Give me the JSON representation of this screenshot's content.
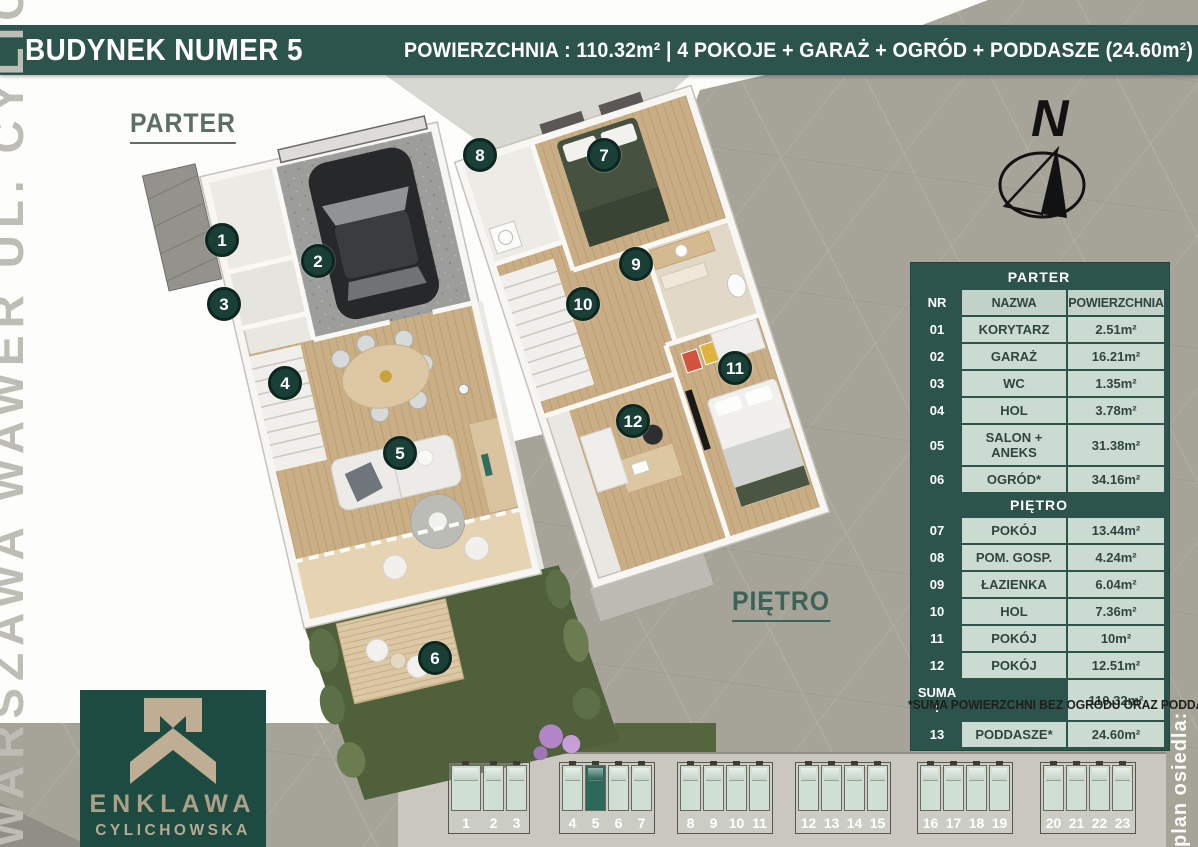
{
  "header": {
    "title": "BUDYNEK NUMER  5",
    "subtitle": "POWIERZCHNIA :  110.32m²  |  4 POKOJE + GARAŻ + OGRÓD + PODDASZE (24.60m²)"
  },
  "side_labels": {
    "left_vertical": "WARSZAWA WAWER UL. CYLICHOWSKA",
    "right_vertical": "plan osiedla:"
  },
  "floors": {
    "ground_label": "PARTER",
    "upper_label": "PIĘTRO"
  },
  "compass": {
    "north": "N"
  },
  "markers": {
    "parter": [
      "1",
      "2",
      "3",
      "4",
      "5",
      "6"
    ],
    "pietro": [
      "7",
      "8",
      "9",
      "10",
      "11",
      "12"
    ]
  },
  "table": {
    "section_parter": "PARTER",
    "columns": [
      "NR",
      "NAZWA",
      "POWIERZCHNIA"
    ],
    "parter_rows": [
      [
        "01",
        "KORYTARZ",
        "2.51m²"
      ],
      [
        "02",
        "GARAŻ",
        "16.21m²"
      ],
      [
        "03",
        "WC",
        "1.35m²"
      ],
      [
        "04",
        "HOL",
        "3.78m²"
      ],
      [
        "05",
        "SALON + ANEKS",
        "31.38m²"
      ],
      [
        "06",
        "OGRÓD*",
        "34.16m²"
      ]
    ],
    "section_pietro": "PIĘTRO",
    "pietro_rows": [
      [
        "07",
        "POKÓJ",
        "13.44m²"
      ],
      [
        "08",
        "POM. GOSP.",
        "4.24m²"
      ],
      [
        "09",
        "ŁAZIENKA",
        "6.04m²"
      ],
      [
        "10",
        "HOL",
        "7.36m²"
      ],
      [
        "11",
        "POKÓJ",
        "10m²"
      ],
      [
        "12",
        "POKÓJ",
        "12.51m²"
      ]
    ],
    "suma": {
      "label": "SUMA :",
      "empty": "",
      "value": "110.32m²"
    },
    "attic_row": [
      "13",
      "PODDASZE*",
      "24.60m²"
    ],
    "footnote": "*SUMA POWIERZCHNI BEZ OGRODU ORAZ PODDASZA"
  },
  "logo": {
    "line1": "ENKLAWA",
    "line2": "CYLICHOWSKA"
  },
  "site_plan": {
    "highlighted_unit": "5",
    "blocks": [
      [
        "1",
        "2",
        "3"
      ],
      [
        "4",
        "5",
        "6",
        "7"
      ],
      [
        "8",
        "9",
        "10",
        "11"
      ],
      [
        "12",
        "13",
        "14",
        "15"
      ],
      [
        "16",
        "17",
        "18",
        "19"
      ],
      [
        "20",
        "21",
        "22",
        "23"
      ]
    ]
  },
  "colors": {
    "brand_green": "#2d544c",
    "logo_green": "#1d4a41",
    "marker_green": "#1a3f37",
    "unit_highlight": "#2d685a",
    "table_light": "#ccdbd1",
    "background_taupe": "#a6a399"
  }
}
